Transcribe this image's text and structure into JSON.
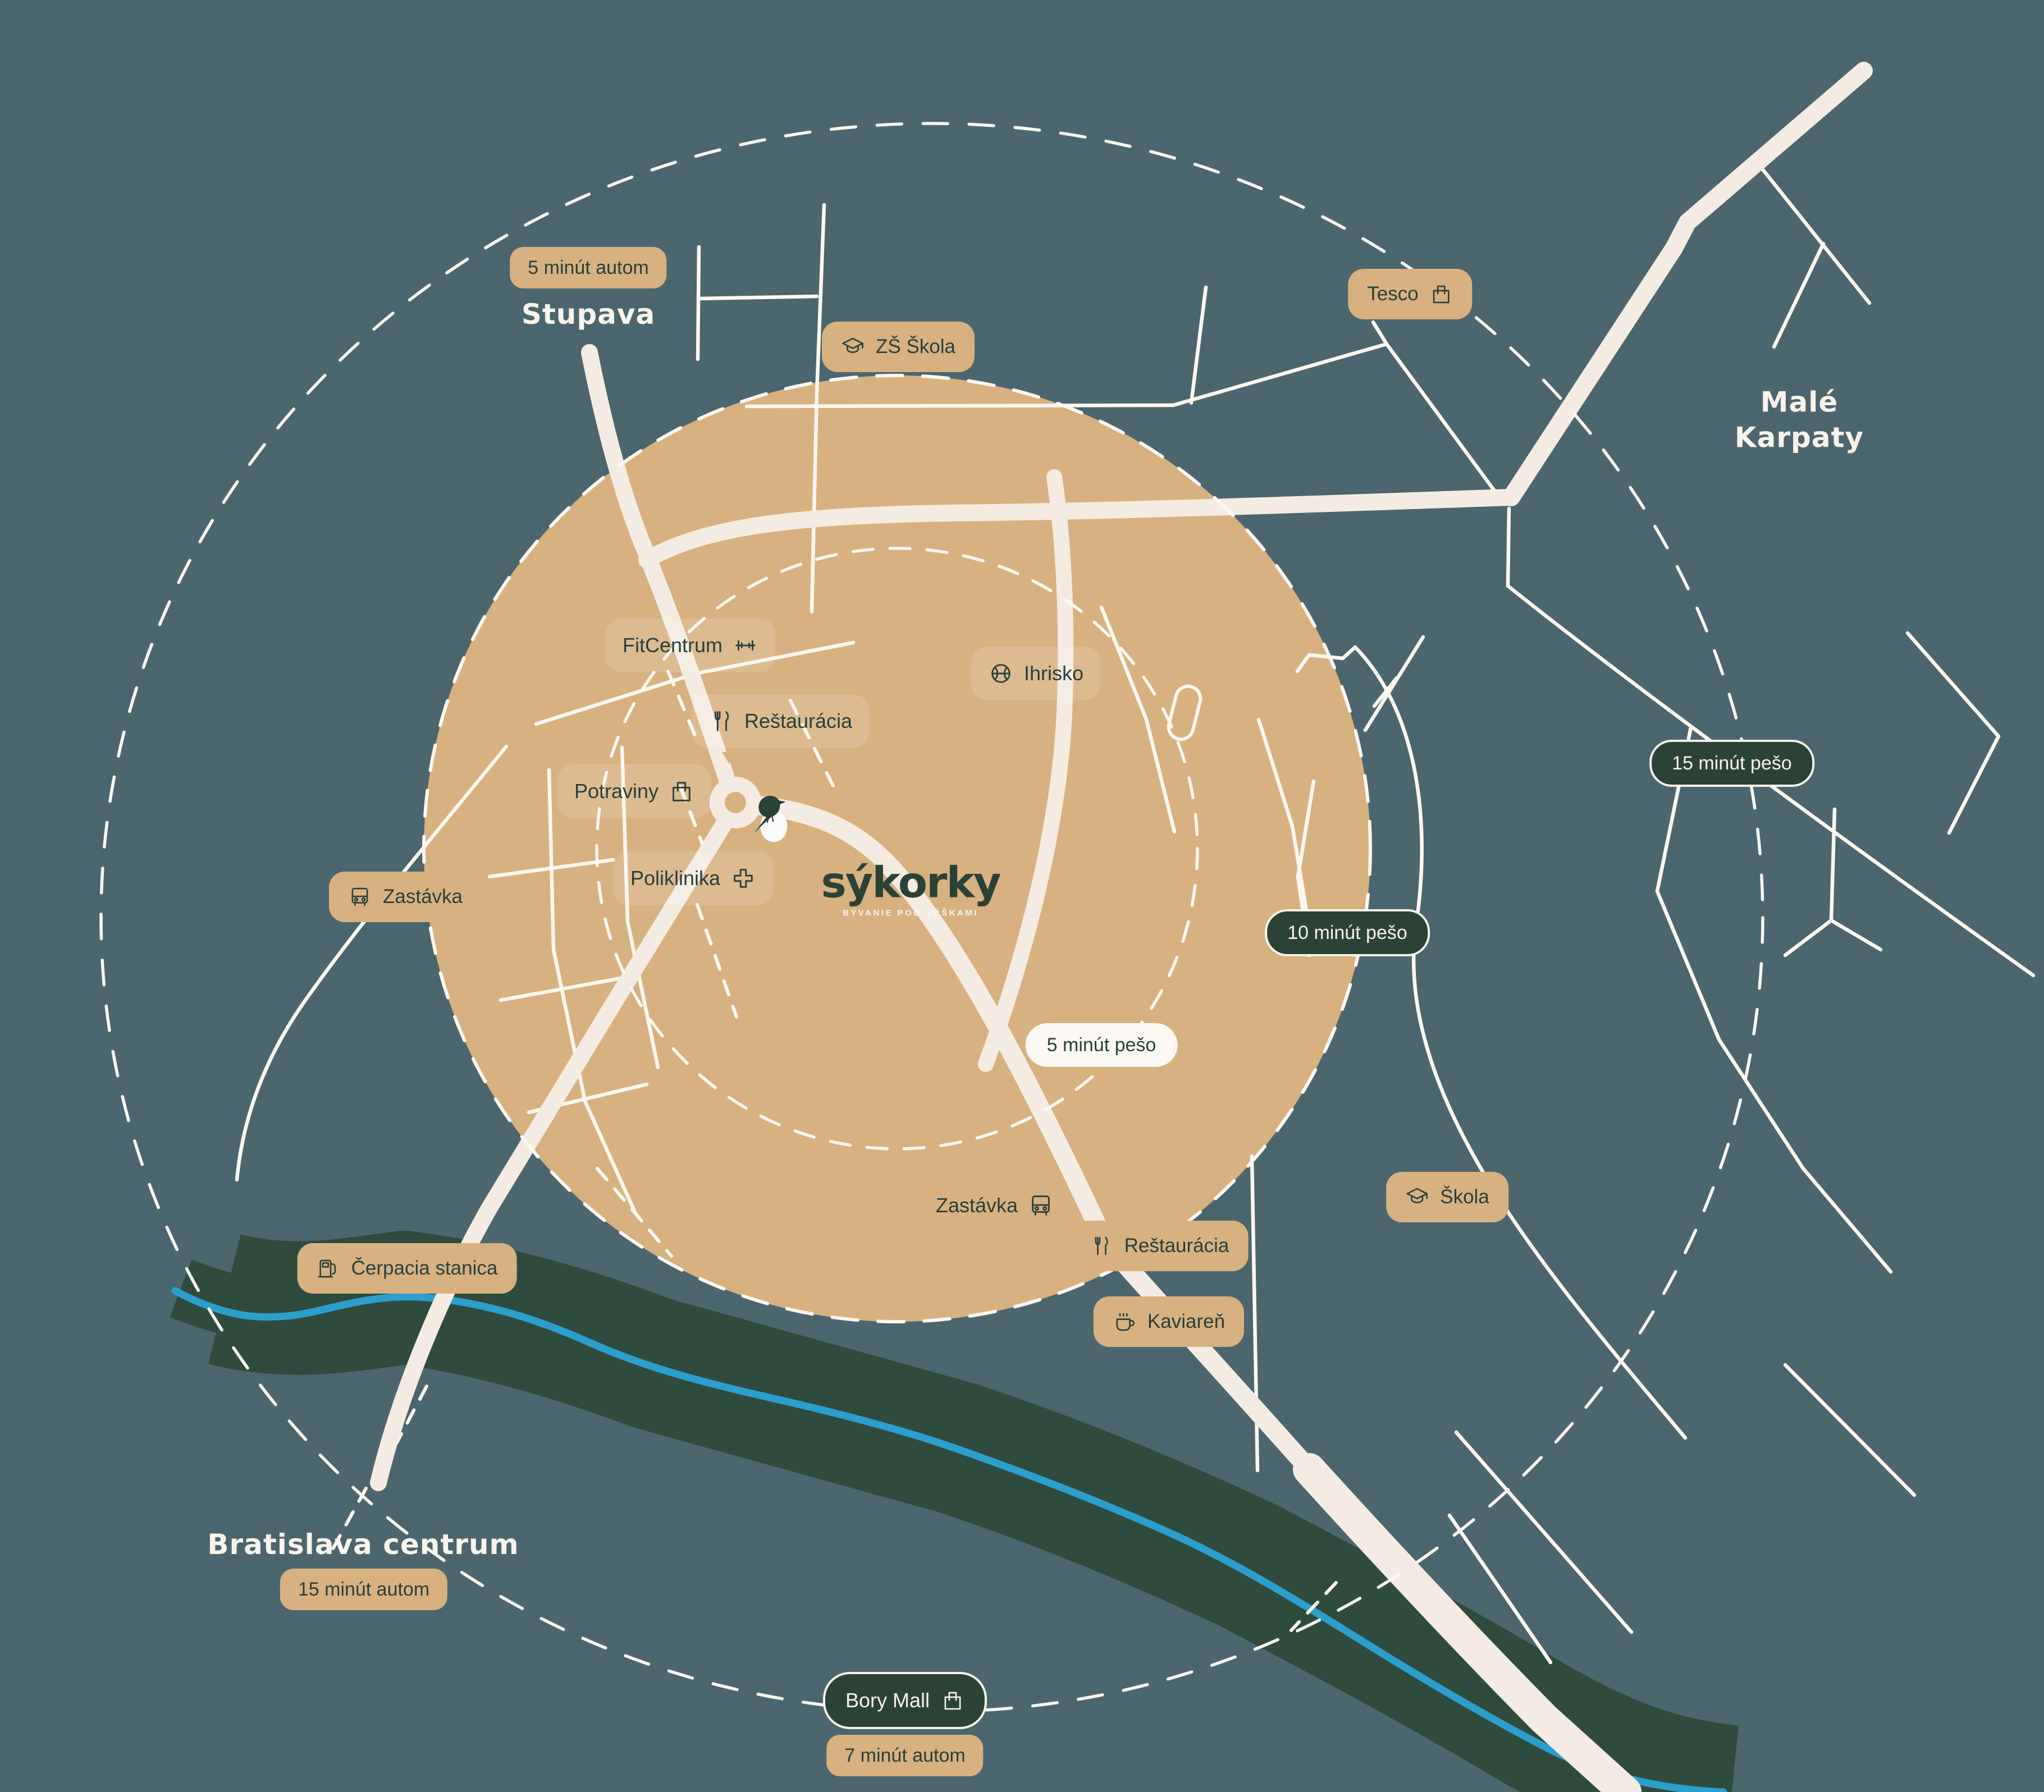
{
  "colors": {
    "background": "#4B666E",
    "walk_radius_fill": "#D8B181",
    "road": "#F4ECE2",
    "road_thin": "#FBF7F1",
    "forest": "#2E4B3E",
    "river": "#2B9FCC",
    "ink": "#27413A",
    "pill_dark": "#2B4336",
    "cream_text": "#F8F4ED"
  },
  "logo": {
    "title": "sýkorky",
    "subtitle": "BÝVANIE POD VŔŠKAMI"
  },
  "places": {
    "stupava": "Stupava",
    "male_karpaty": [
      "Malé",
      "Karpaty"
    ],
    "bratislava": "Bratislava centrum"
  },
  "travel": {
    "stupava_car": "5 minút autom",
    "bratislava_car": "15 minút autom",
    "bory_car": "7 minút autom",
    "walk_5": "5 minút pešo",
    "walk_10": "10 minút pešo",
    "walk_15": "15 minút pešo"
  },
  "pois": {
    "tesco": "Tesco",
    "zs_skola": "ZŠ Škola",
    "fitcentrum": "FitCentrum",
    "restauracia_center": "Reštaurácia",
    "potraviny": "Potraviny",
    "poliklinika": "Poliklinika",
    "ihrisko": "Ihrisko",
    "zastavka_west": "Zastávka",
    "zastavka_south": "Zastávka",
    "cerpacia_stanica": "Čerpacia stanica",
    "restauracia_east": "Reštaurácia",
    "kaviaren": "Kaviareň",
    "skola": "Škola",
    "bory_mall": "Bory Mall"
  }
}
